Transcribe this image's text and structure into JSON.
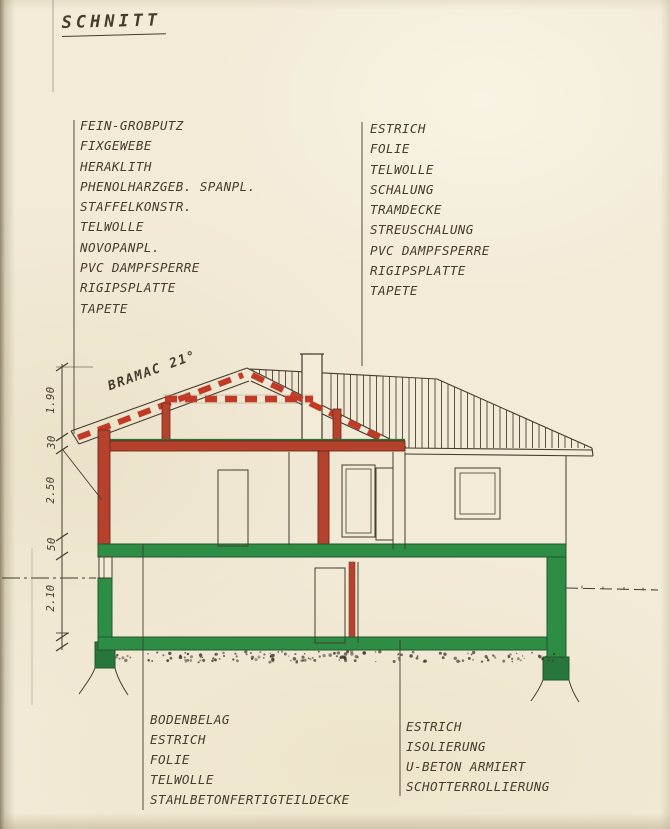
{
  "title": {
    "text": "SCHNITT"
  },
  "roof_annotation": {
    "text": "BRAMAC 21°"
  },
  "dimension_labels": {
    "roof": "1.90",
    "attic_floor": "30",
    "ground_floor": "2.50",
    "slab": "50",
    "basement": "2.10"
  },
  "layer_lists": {
    "wall": {
      "items": [
        "FEIN-GROBPUTZ",
        "FIXGEWEBE",
        "HERAKLITH",
        "PHENOLHARZGEB. SPANPL.",
        "STAFFELKONSTR.",
        "TELWOLLE",
        "NOVOPANPL.",
        "PVC DAMPFSPERRE",
        "RIGIPSPLATTE",
        "TAPETE"
      ]
    },
    "ceiling": {
      "items": [
        "ESTRICH",
        "FOLIE",
        "TELWOLLE",
        "SCHALUNG",
        "TRAMDECKE",
        "STREUSCHALUNG",
        "PVC DAMPFSPERRE",
        "RIGIPSPLATTE",
        "TAPETE"
      ]
    },
    "floor": {
      "items": [
        "BODENBELAG",
        "ESTRICH",
        "FOLIE",
        "TELWOLLE",
        "STAHLBETONFERTIGTEILDECKE"
      ]
    },
    "foundation": {
      "items": [
        "ESTRICH",
        "ISOLIERUNG",
        "U-BETON ARMIERT",
        "SCHOTTERROLLIERUNG"
      ]
    }
  },
  "colors": {
    "paper": "#f2ebd8",
    "ink": "#453b2e",
    "red_fill": "#b5422d",
    "red_dash": "#c23a26",
    "red_outline": "#6e2718",
    "green_fill": "#2e8d45",
    "green_outline": "#22582f"
  }
}
